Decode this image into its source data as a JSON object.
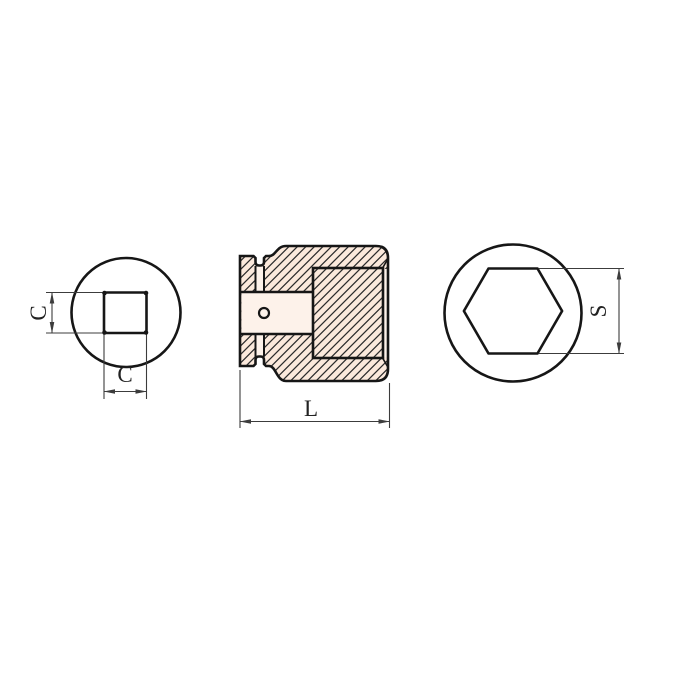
{
  "page": {
    "background": "#ffffff"
  },
  "drawing": {
    "description": "Technical drawing of an impact socket: square drive end view, cross-section side view, hex socket end view",
    "colors": {
      "outline": "#161616",
      "dimension_line": "#3c3c3c",
      "body_fill": "#fbe9dc",
      "hole_fill": "#fdf2ea",
      "hatch_line": "#2b2b2b",
      "label_text": "#222222"
    },
    "views": {
      "drive_end": {
        "name": "square drive end view",
        "dim_height": "C",
        "dim_width": "C"
      },
      "section": {
        "name": "side cross-section view",
        "dim_length": "L"
      },
      "socket_end": {
        "name": "hex socket end view",
        "dim_across_flats": "S"
      }
    }
  }
}
